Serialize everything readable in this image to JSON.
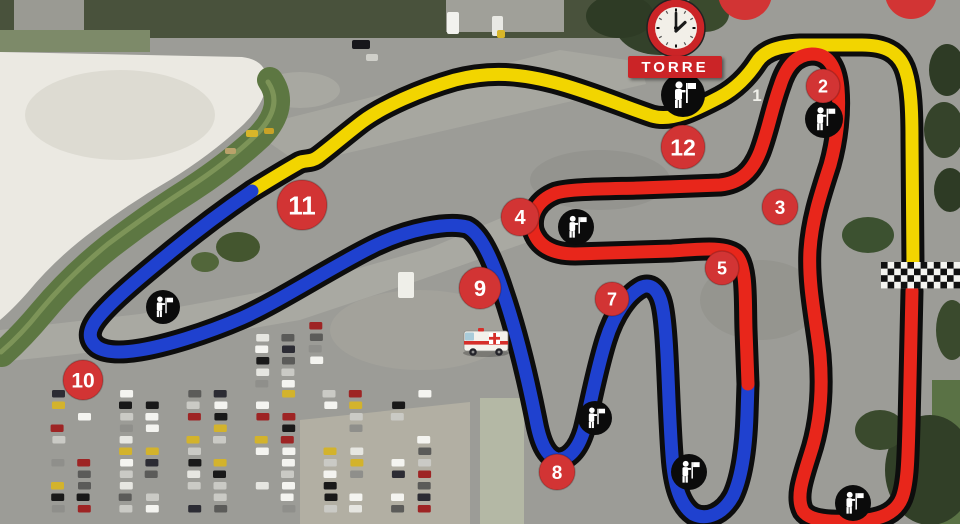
{
  "tower": {
    "label": "TORRE"
  },
  "road_markings": [
    {
      "label": "1",
      "x": 757,
      "y": 101
    }
  ],
  "colors": {
    "track_yellow": "#f2d500",
    "track_blue": "#1f41cf",
    "track_red": "#e8261b",
    "track_casing": "#0d0d0d",
    "marker_red": "#d23434",
    "marker_text": "#ffffff",
    "sign_red": "#cb2427",
    "marshal_bg": "#0b0b0b",
    "marshal_fg": "#ffffff"
  },
  "track": {
    "segments": [
      {
        "name": "sector-yellow",
        "color": "#f2d500",
        "path": "M 252 191 C 265 183 283 172 297 164 C 304 159 310 163 318 157 C 330 148 345 135 362 122 C 382 107 420 90 455 80 C 490 71 520 73 560 84 C 595 94 625 107 652 116 C 672 122 695 110 720 97 C 735 89 748 76 757 62 C 764 51 778 46 800 45 L 862 45 C 885 45 900 52 906 72 C 911 88 912 110 912 140 L 913 266"
      },
      {
        "name": "sector-blue",
        "color": "#1f41cf",
        "path": "M 252 191 C 230 206 200 228 172 251 C 144 274 112 300 97 319 C 88 331 88 340 97 347 C 106 353 122 353 140 350 C 165 346 205 334 242 318 C 278 302 330 268 372 247 C 408 229 448 222 467 227 C 480 233 492 258 503 292 C 515 327 527 375 536 420 C 540 442 546 456 557 459 C 568 460 578 450 584 430 C 590 407 596 372 606 340 C 614 314 628 294 642 287 C 652 283 660 291 663 310 C 668 340 668 400 672 455 C 674 485 680 505 693 514 C 707 521 723 514 733 496 C 742 477 746 445 747 415 L 748 384"
      },
      {
        "name": "sector-red",
        "color": "#e8261b",
        "path": "M 748 384 L 746 330 C 745 300 747 268 737 256 C 727 246 700 249 672 251 L 575 254 C 552 254 538 246 533 230 C 530 214 538 200 556 193 C 570 189 600 189 640 188 L 720 185 C 740 183 752 172 760 152 C 768 131 772 108 780 86 C 786 67 795 55 812 54 C 828 54 836 66 838 88 C 840 112 837 140 830 165 C 820 196 812 220 810 250 C 808 285 816 320 820 355 C 823 390 820 425 810 455 C 802 480 796 498 803 511 C 810 521 830 522 855 521 C 878 520 895 515 902 498 C 908 482 908 455 909 425 L 912 291"
      }
    ],
    "corner_markers": [
      {
        "label": "2",
        "x": 823,
        "y": 86,
        "r": 17
      },
      {
        "label": "3",
        "x": 780,
        "y": 207,
        "r": 18
      },
      {
        "label": "4",
        "x": 520,
        "y": 217,
        "r": 19
      },
      {
        "label": "5",
        "x": 722,
        "y": 268,
        "r": 17
      },
      {
        "label": "7",
        "x": 612,
        "y": 299,
        "r": 17
      },
      {
        "label": "8",
        "x": 557,
        "y": 472,
        "r": 18
      },
      {
        "label": "9",
        "x": 480,
        "y": 288,
        "r": 21
      },
      {
        "label": "10",
        "x": 83,
        "y": 380,
        "r": 20
      },
      {
        "label": "11",
        "x": 302,
        "y": 205,
        "r": 25
      },
      {
        "label": "12",
        "x": 683,
        "y": 147,
        "r": 22
      }
    ],
    "partial_markers": [
      {
        "x": 745,
        "y": -7,
        "r": 27
      },
      {
        "x": 911,
        "y": -7,
        "r": 26
      }
    ],
    "finish_line": {
      "x": 881,
      "y": 262,
      "cols": 13,
      "rows": 4,
      "cell": 6.6
    }
  },
  "marshals": [
    {
      "x": 683,
      "y": 95,
      "r": 22
    },
    {
      "x": 824,
      "y": 119,
      "r": 19
    },
    {
      "x": 576,
      "y": 227,
      "r": 18
    },
    {
      "x": 163,
      "y": 307,
      "r": 17
    },
    {
      "x": 595,
      "y": 418,
      "r": 17
    },
    {
      "x": 689,
      "y": 472,
      "r": 18
    },
    {
      "x": 853,
      "y": 503,
      "r": 18
    }
  ],
  "clock": {
    "cx": 676,
    "cy": 28,
    "r": 29,
    "ring": "#cb2427",
    "face": "#f2efe8",
    "hands": "#1a1a1a"
  },
  "ambulance": {
    "cx": 486,
    "cy": 343
  },
  "tower_sign_box": {
    "x": 628,
    "y": 56,
    "w": 94,
    "h": 22
  },
  "background": {
    "base": "#9c9c97",
    "shapes": [
      {
        "t": "rect",
        "x": 0,
        "y": 0,
        "w": 640,
        "h": 38,
        "f": "#49523c"
      },
      {
        "t": "rect",
        "x": 14,
        "y": 0,
        "w": 70,
        "h": 40,
        "f": "#9a9a93"
      },
      {
        "t": "rect",
        "x": 446,
        "y": 0,
        "w": 118,
        "h": 32,
        "f": "#a0a099"
      },
      {
        "t": "rect",
        "x": 0,
        "y": 30,
        "w": 150,
        "h": 22,
        "f": "#7d8a69"
      },
      {
        "t": "ellipse",
        "cx": 300,
        "cy": 90,
        "rx": 40,
        "ry": 18,
        "f": "#a8a8a1"
      },
      {
        "t": "path",
        "d": "M 248 128 L 560 50 L 640 62 L 646 84 L 300 164 Z",
        "f": "#a7a7a0"
      },
      {
        "t": "path",
        "d": "M 0 330 L 140 314 L 300 285 L 430 248 L 520 210 L 545 236 L 420 280 L 300 320 L 150 346 L 0 362 Z",
        "f": "#a9a9a2"
      },
      {
        "t": "ellipse",
        "cx": 420,
        "cy": 330,
        "rx": 90,
        "ry": 40,
        "f": "#a3a29b"
      },
      {
        "t": "ellipse",
        "cx": 600,
        "cy": 180,
        "rx": 70,
        "ry": 30,
        "f": "#94948f"
      },
      {
        "t": "ellipse",
        "cx": 760,
        "cy": 300,
        "rx": 60,
        "ry": 40,
        "f": "#95958f"
      },
      {
        "t": "path",
        "d": "M 300 420 L 470 402 L 470 524 L 300 524 Z",
        "f": "#b2afa3"
      },
      {
        "t": "rect",
        "x": 480,
        "y": 398,
        "w": 44,
        "h": 126,
        "f": "#b4b8a5"
      },
      {
        "t": "path",
        "d": "M 0 52 L 242 57 Q 266 60 267 80 Q 266 102 244 124 Q 212 154 170 180 Q 130 203 94 230 Q 56 258 28 292 Q 12 310 0 320 Z",
        "f": "#ebe9e2"
      },
      {
        "t": "ellipse",
        "cx": 120,
        "cy": 115,
        "rx": 95,
        "ry": 45,
        "f": "#dddbd2"
      },
      {
        "t": "path",
        "d": "M 270 80 Q 288 106 260 136 Q 230 164 190 190 Q 150 215 110 246 Q 72 276 42 312 Q 22 336 2 354",
        "f": "none",
        "s": "#5d7742",
        "sw": 26
      },
      {
        "t": "path",
        "d": "M 268 82 Q 284 106 257 134 Q 228 162 188 188 Q 148 214 108 244 Q 70 275 40 311 Q 21 335 1 352",
        "f": "none",
        "s": "#7d9458",
        "sw": 5
      },
      {
        "t": "ellipse",
        "cx": 238,
        "cy": 247,
        "rx": 22,
        "ry": 15,
        "f": "#44562f"
      },
      {
        "t": "ellipse",
        "cx": 205,
        "cy": 262,
        "rx": 14,
        "ry": 10,
        "f": "#52663a"
      },
      {
        "t": "ellipse",
        "cx": 660,
        "cy": 25,
        "rx": 45,
        "ry": 30,
        "f": "#33412a"
      },
      {
        "t": "ellipse",
        "cx": 620,
        "cy": 16,
        "rx": 34,
        "ry": 22,
        "f": "#2e3b25"
      },
      {
        "t": "ellipse",
        "cx": 705,
        "cy": 14,
        "rx": 24,
        "ry": 18,
        "f": "#3a4a2d"
      },
      {
        "t": "ellipse",
        "cx": 868,
        "cy": 235,
        "rx": 26,
        "ry": 18,
        "f": "#3c5130"
      },
      {
        "t": "ellipse",
        "cx": 947,
        "cy": 70,
        "rx": 18,
        "ry": 26,
        "f": "#2e3b25"
      },
      {
        "t": "ellipse",
        "cx": 944,
        "cy": 130,
        "rx": 20,
        "ry": 28,
        "f": "#35432a"
      },
      {
        "t": "ellipse",
        "cx": 950,
        "cy": 190,
        "rx": 16,
        "ry": 22,
        "f": "#2e3b25"
      },
      {
        "t": "rect",
        "x": 932,
        "y": 380,
        "w": 28,
        "h": 144,
        "f": "#5a7245"
      },
      {
        "t": "ellipse",
        "cx": 930,
        "cy": 470,
        "rx": 45,
        "ry": 55,
        "f": "#313f27"
      },
      {
        "t": "ellipse",
        "cx": 880,
        "cy": 430,
        "rx": 25,
        "ry": 20,
        "f": "#3a4a2d"
      },
      {
        "t": "ellipse",
        "cx": 952,
        "cy": 330,
        "rx": 16,
        "ry": 30,
        "f": "#3a4a2d"
      }
    ],
    "parking": {
      "columns": [
        58,
        84,
        126,
        152,
        194,
        220,
        262,
        288,
        330,
        356,
        398,
        424
      ],
      "y0": 390,
      "y1": 516,
      "step": 11.5,
      "car_w": 13,
      "car_h": 7.5,
      "fill": 0.78,
      "extra_columns": [
        {
          "x": 262,
          "y0": 334,
          "y1": 388
        },
        {
          "x": 288,
          "y0": 334,
          "y1": 388
        },
        {
          "x": 316,
          "y0": 322,
          "y1": 362
        }
      ],
      "palette": [
        "#f4f4f0",
        "#f4f4f0",
        "#191919",
        "#191919",
        "#5b5b59",
        "#cacac5",
        "#cacac5",
        "#9e2424",
        "#d3b32c",
        "#2c2c34",
        "#8f8f8b",
        "#e6e6e1",
        "#f4f4f0"
      ]
    },
    "vehicles": [
      {
        "x": 352,
        "y": 40,
        "w": 18,
        "h": 9,
        "c": "#17171b"
      },
      {
        "x": 447,
        "y": 12,
        "w": 12,
        "h": 22,
        "c": "#f2f2ee"
      },
      {
        "x": 492,
        "y": 16,
        "w": 11,
        "h": 20,
        "c": "#e9e9e4"
      },
      {
        "x": 497,
        "y": 30,
        "w": 8,
        "h": 8,
        "c": "#d8b62a"
      },
      {
        "x": 366,
        "y": 54,
        "w": 12,
        "h": 7,
        "c": "#cfcfc9"
      },
      {
        "x": 398,
        "y": 272,
        "w": 16,
        "h": 26,
        "c": "#efefe9"
      },
      {
        "x": 246,
        "y": 130,
        "w": 12,
        "h": 7,
        "c": "#d8b62a"
      },
      {
        "x": 264,
        "y": 128,
        "w": 10,
        "h": 6,
        "c": "#c9a227"
      },
      {
        "x": 225,
        "y": 148,
        "w": 11,
        "h": 6,
        "c": "#b9a26a"
      }
    ]
  }
}
